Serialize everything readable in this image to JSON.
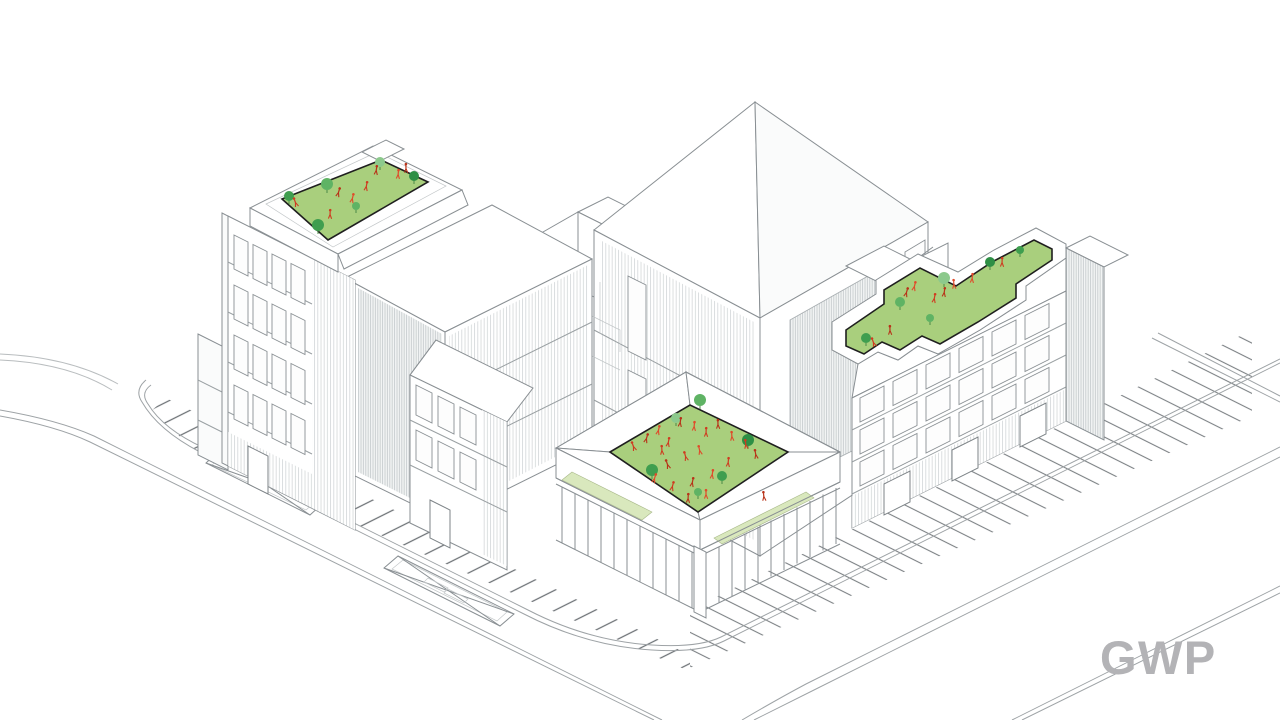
{
  "canvas": {
    "width": 1280,
    "height": 720,
    "background": "#ffffff",
    "description": "Axonometric architectural line drawing of an urban block: three buildings with green roof gardens populated by trees and red human figures, a large pyramid-roof hall, a podium building with roof courtyard and ground-floor colonnade, surrounded by streets with striped sidewalk paving and planters."
  },
  "branding": {
    "logo_text": "GWP",
    "logo_color": "#b3b3b6"
  },
  "palette": {
    "line": "#898f93",
    "line_light": "#b9bdbf",
    "hatch": "#d3d7d8",
    "paving": "#666c70",
    "grass": "#a9cf7d",
    "grass_light": "#d9e8bd",
    "grass_border": "#1f1f1f",
    "tree_greens": [
      "#3f9e4f",
      "#5fb364",
      "#8cc98c",
      "#2e8f45"
    ],
    "person_reds": [
      "#cf3b20",
      "#b83218",
      "#e04a2a"
    ],
    "logo": "#b3b3b6"
  },
  "scene": {
    "roof_gardens": [
      {
        "name": "left-roof-garden-items",
        "trees": [
          [
            289,
            196,
            5
          ],
          [
            327,
            184,
            6
          ],
          [
            380,
            162,
            5
          ],
          [
            414,
            176,
            5
          ],
          [
            318,
            225,
            6
          ],
          [
            356,
            206,
            4
          ]
        ],
        "people": [
          [
            296,
            204
          ],
          [
            338,
            194
          ],
          [
            352,
            200
          ],
          [
            366,
            188
          ],
          [
            376,
            172
          ],
          [
            398,
            176
          ],
          [
            330,
            216
          ],
          [
            406,
            170
          ]
        ]
      },
      {
        "name": "courtyard-roof-garden-items",
        "trees": [
          [
            652,
            470,
            6
          ],
          [
            700,
            400,
            6
          ],
          [
            676,
            418,
            5
          ],
          [
            748,
            440,
            6
          ],
          [
            722,
            476,
            5
          ],
          [
            698,
            492,
            4
          ]
        ],
        "people": [
          [
            634,
            448
          ],
          [
            646,
            440
          ],
          [
            658,
            432
          ],
          [
            668,
            444
          ],
          [
            680,
            424
          ],
          [
            694,
            428
          ],
          [
            706,
            434
          ],
          [
            718,
            426
          ],
          [
            732,
            438
          ],
          [
            746,
            446
          ],
          [
            756,
            456
          ],
          [
            700,
            452
          ],
          [
            686,
            458
          ],
          [
            668,
            466
          ],
          [
            654,
            480
          ],
          [
            672,
            488
          ],
          [
            692,
            484
          ],
          [
            712,
            476
          ],
          [
            728,
            464
          ],
          [
            688,
            500
          ],
          [
            706,
            496
          ],
          [
            662,
            452
          ],
          [
            764,
            498
          ]
        ]
      },
      {
        "name": "right-roof-terrace-garden-items",
        "trees": [
          [
            866,
            338,
            5
          ],
          [
            900,
            302,
            5
          ],
          [
            944,
            278,
            6
          ],
          [
            990,
            262,
            5
          ],
          [
            1020,
            250,
            4
          ],
          [
            930,
            318,
            4
          ]
        ],
        "people": [
          [
            874,
            344
          ],
          [
            906,
            294
          ],
          [
            914,
            288
          ],
          [
            934,
            300
          ],
          [
            944,
            294
          ],
          [
            972,
            280
          ],
          [
            1002,
            264
          ],
          [
            890,
            332
          ],
          [
            954,
            286
          ]
        ]
      }
    ]
  }
}
